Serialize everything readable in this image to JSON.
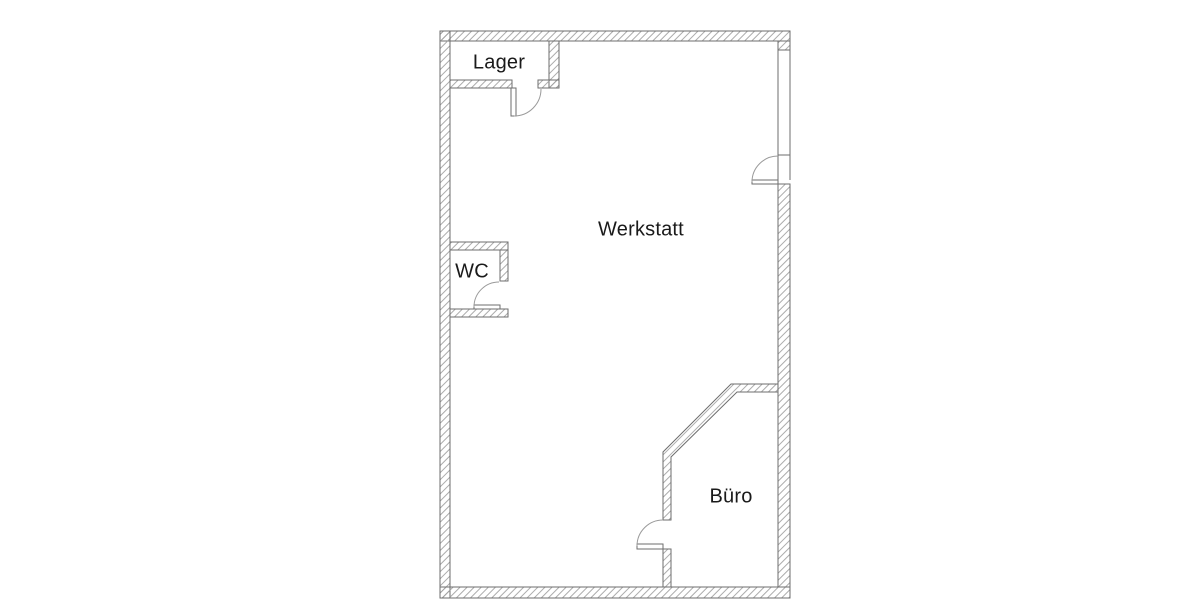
{
  "rooms": [
    {
      "name": "lager",
      "label": "Lager"
    },
    {
      "name": "werkstatt",
      "label": "Werkstatt"
    },
    {
      "name": "wc",
      "label": "WC"
    },
    {
      "name": "buero",
      "label": "Büro"
    }
  ],
  "openings": [
    "lager-door",
    "wc-door",
    "werkstatt-right-door",
    "werkstatt-right-window",
    "buero-door"
  ],
  "colors": {
    "background": "#ffffff",
    "wall_outline": "#6e6e6e",
    "hatch": "#a2a2a2",
    "symbol": "#9a9a9a",
    "text": "#1a1a1a"
  }
}
